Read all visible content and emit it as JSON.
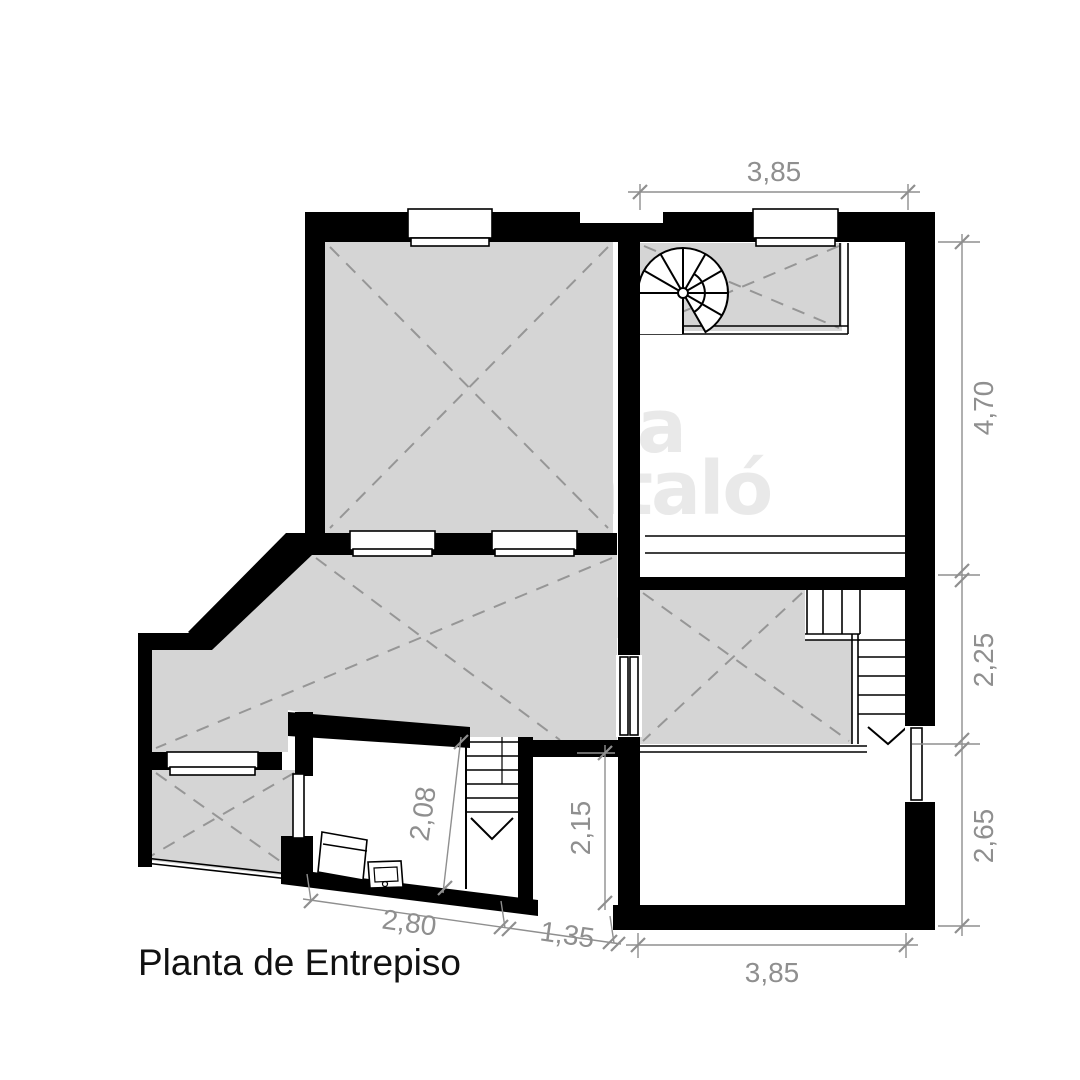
{
  "title": "Planta de Entrepiso",
  "watermark": {
    "line1": "alicia",
    "line2": "santaló",
    "line3": "+",
    "line4": "equipo."
  },
  "dimensions": {
    "top_width": "3,85",
    "right_upper": "4,70",
    "right_mid": "2,25",
    "right_lower": "2,65",
    "bottom_width": "3,85",
    "desk_room_depth": "2,08",
    "hall_depth": "2,15",
    "bottom_left_width": "2,80",
    "bottom_mid_width": "1,35"
  },
  "colors": {
    "paper": "#ffffff",
    "wall": "#000000",
    "shade": "#d5d5d5",
    "dash": "#969696",
    "dim": "#8f8f8f",
    "title": "#111111",
    "watermark": "rgba(0,0,0,0.085)"
  }
}
